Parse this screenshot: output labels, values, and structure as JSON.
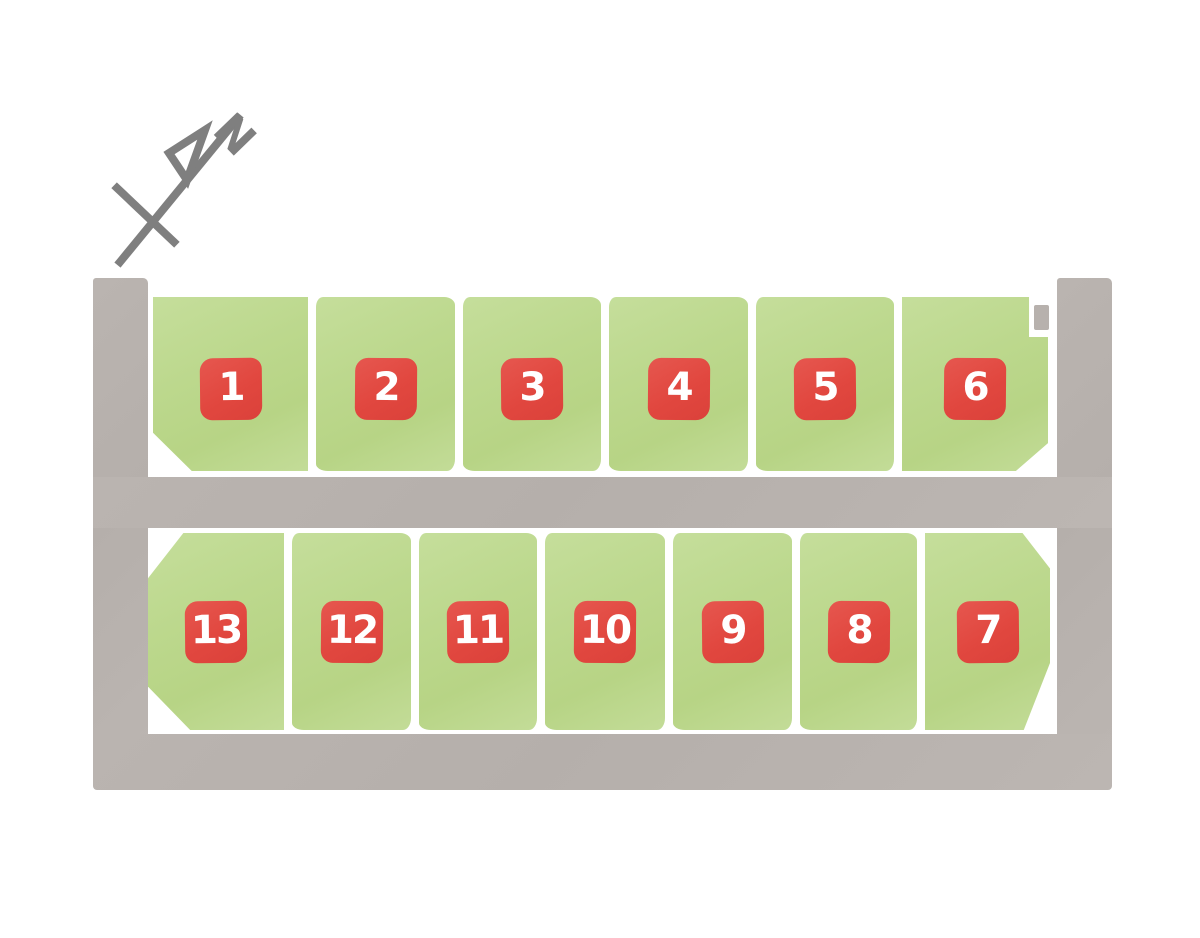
{
  "title": "Residential subdivision lot layout plan",
  "compass": {
    "label": "N"
  },
  "colors": {
    "background": "#ffffff",
    "road_gray": "#b7b1ad",
    "plot_green": "#bcd88d",
    "lot_marker_red": "#e1473f",
    "lot_number_text": "#ffffff",
    "compass_gray": "#7f7f7f",
    "divider_white": "#ffffff"
  },
  "lots": {
    "top_row": [
      {
        "number": "1"
      },
      {
        "number": "2"
      },
      {
        "number": "3"
      },
      {
        "number": "4"
      },
      {
        "number": "5"
      },
      {
        "number": "6"
      }
    ],
    "bottom_row": [
      {
        "number": "13"
      },
      {
        "number": "12"
      },
      {
        "number": "11"
      },
      {
        "number": "10"
      },
      {
        "number": "9"
      },
      {
        "number": "8"
      },
      {
        "number": "7"
      }
    ]
  }
}
